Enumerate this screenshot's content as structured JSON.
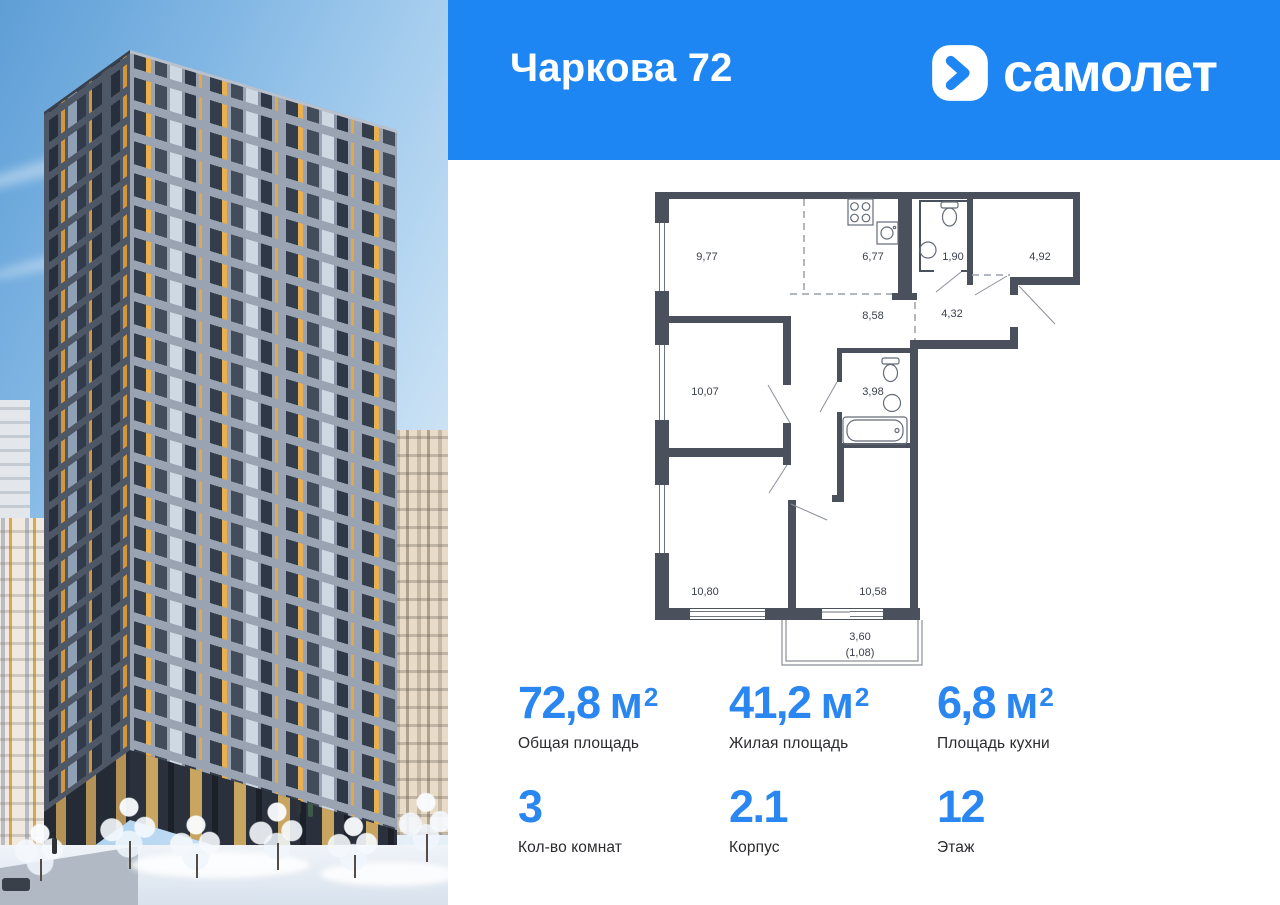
{
  "header": {
    "title": "Чаркова 72",
    "brand": "самолет"
  },
  "colors": {
    "brand_blue": "#1e86f2",
    "accent_blue": "#2a86f0",
    "text_dark": "#2b2b30",
    "plan_wall": "#4b515c",
    "accent_yellow": "#e2a944"
  },
  "plan": {
    "labels": {
      "r977": "9,77",
      "r677": "6,77",
      "r190": "1,90",
      "r492": "4,92",
      "r858": "8,58",
      "r432": "4,32",
      "r1007": "10,07",
      "r398": "3,98",
      "r1080": "10,80",
      "r1058": "10,58",
      "balcony_area": "3,60",
      "balcony_area_reduced": "(1,08)"
    }
  },
  "stats": [
    {
      "value": "72,8",
      "unit": "м",
      "sup": "2",
      "label": "Общая площадь"
    },
    {
      "value": "41,2",
      "unit": "м",
      "sup": "2",
      "label": "Жилая площадь"
    },
    {
      "value": "6,8",
      "unit": "м",
      "sup": "2",
      "label": "Площадь кухни"
    },
    {
      "value": "3",
      "unit": "",
      "sup": "",
      "label": "Кол-во комнат"
    },
    {
      "value": "2.1",
      "unit": "",
      "sup": "",
      "label": "Корпус"
    },
    {
      "value": "12",
      "unit": "",
      "sup": "",
      "label": "Этаж"
    }
  ]
}
